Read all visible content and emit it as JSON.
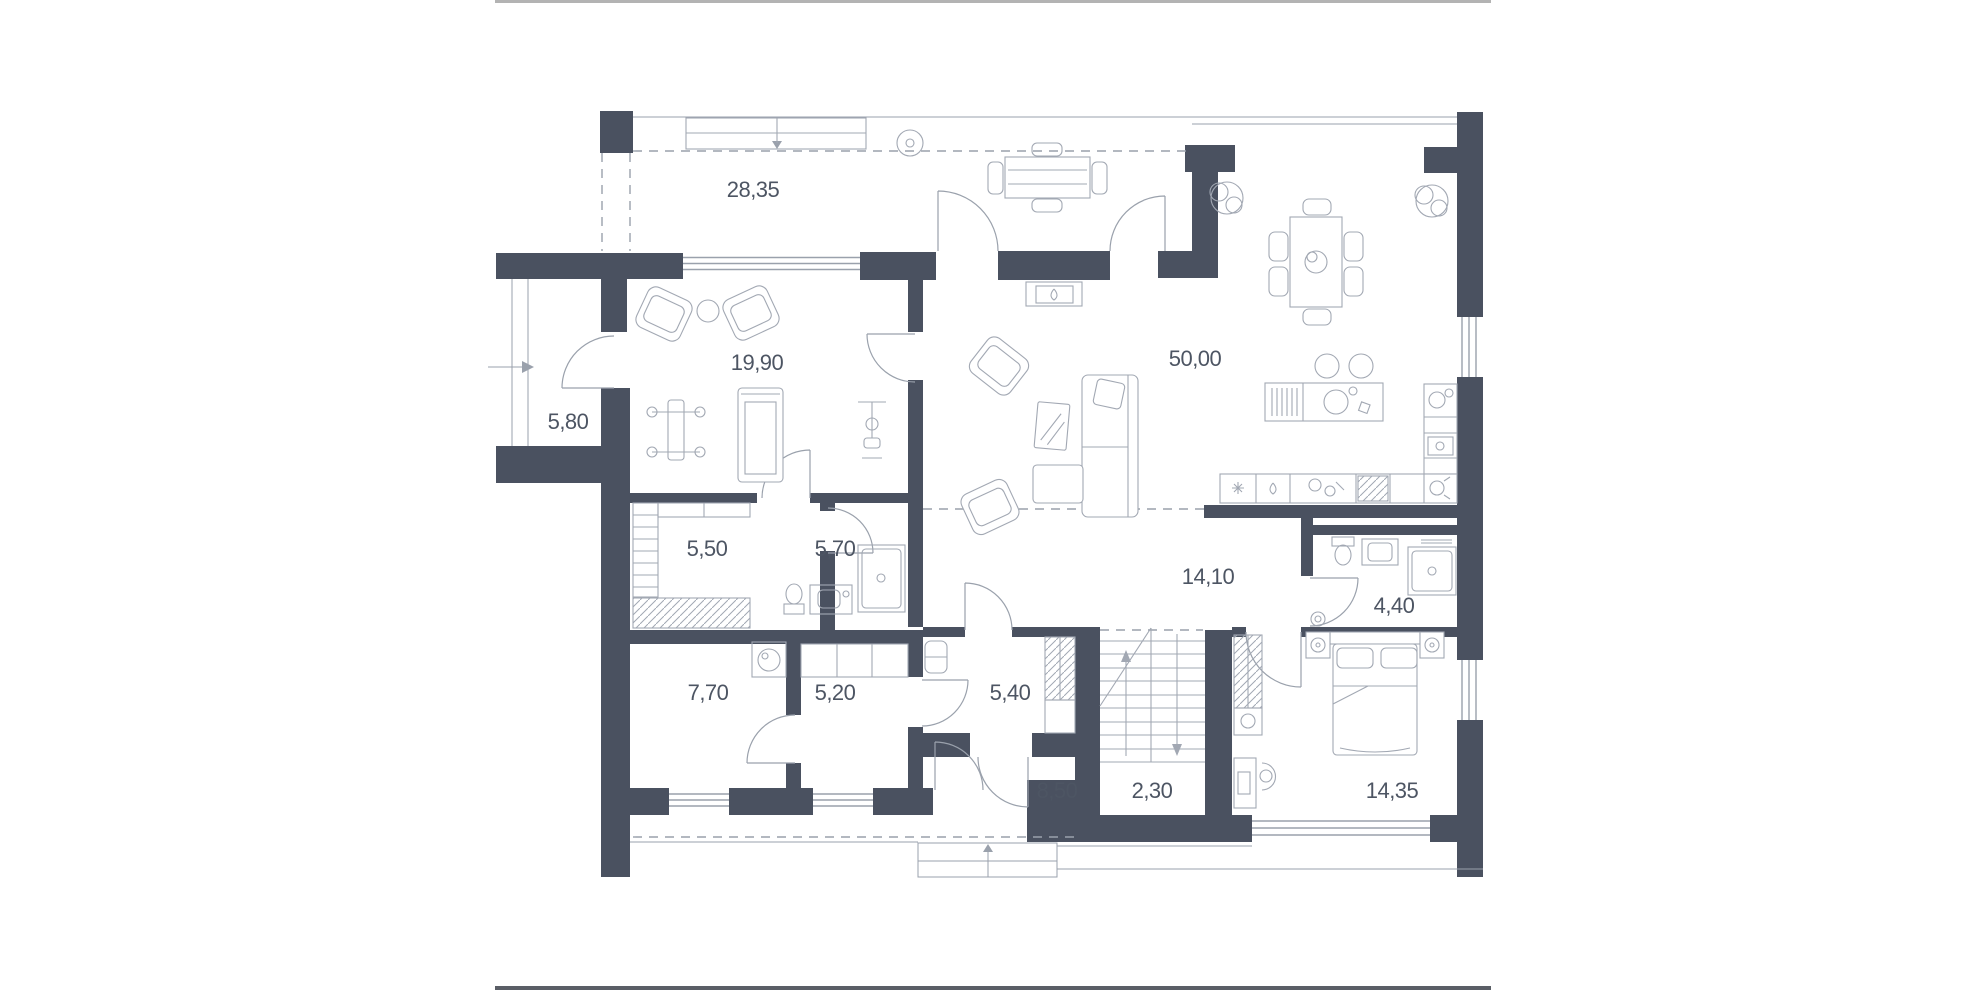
{
  "title": "Floor plan",
  "floor_plan": {
    "colors": {
      "wall": "#4a5160",
      "line": "#9aa1ac",
      "furniture": "#a2a8b3",
      "label": "#4d5563",
      "frame_top": "#b3b3b3",
      "frame_bottom": "#5a5e66"
    },
    "rooms": [
      {
        "name": "terrace",
        "area": "28,35"
      },
      {
        "name": "side-porch",
        "area": "5,80"
      },
      {
        "name": "gym",
        "area": "19,90"
      },
      {
        "name": "living-kitchen",
        "area": "50,00"
      },
      {
        "name": "sauna",
        "area": "5,50"
      },
      {
        "name": "shower-room",
        "area": "5,70"
      },
      {
        "name": "hallway",
        "area": "14,10"
      },
      {
        "name": "bathroom",
        "area": "4,40"
      },
      {
        "name": "laundry",
        "area": "7,70"
      },
      {
        "name": "boot-room",
        "area": "5,20"
      },
      {
        "name": "inner-hall",
        "area": "5,40"
      },
      {
        "name": "entry",
        "area": "8,50"
      },
      {
        "name": "stairs",
        "area": "2,30"
      },
      {
        "name": "bedroom",
        "area": "14,35"
      }
    ]
  }
}
